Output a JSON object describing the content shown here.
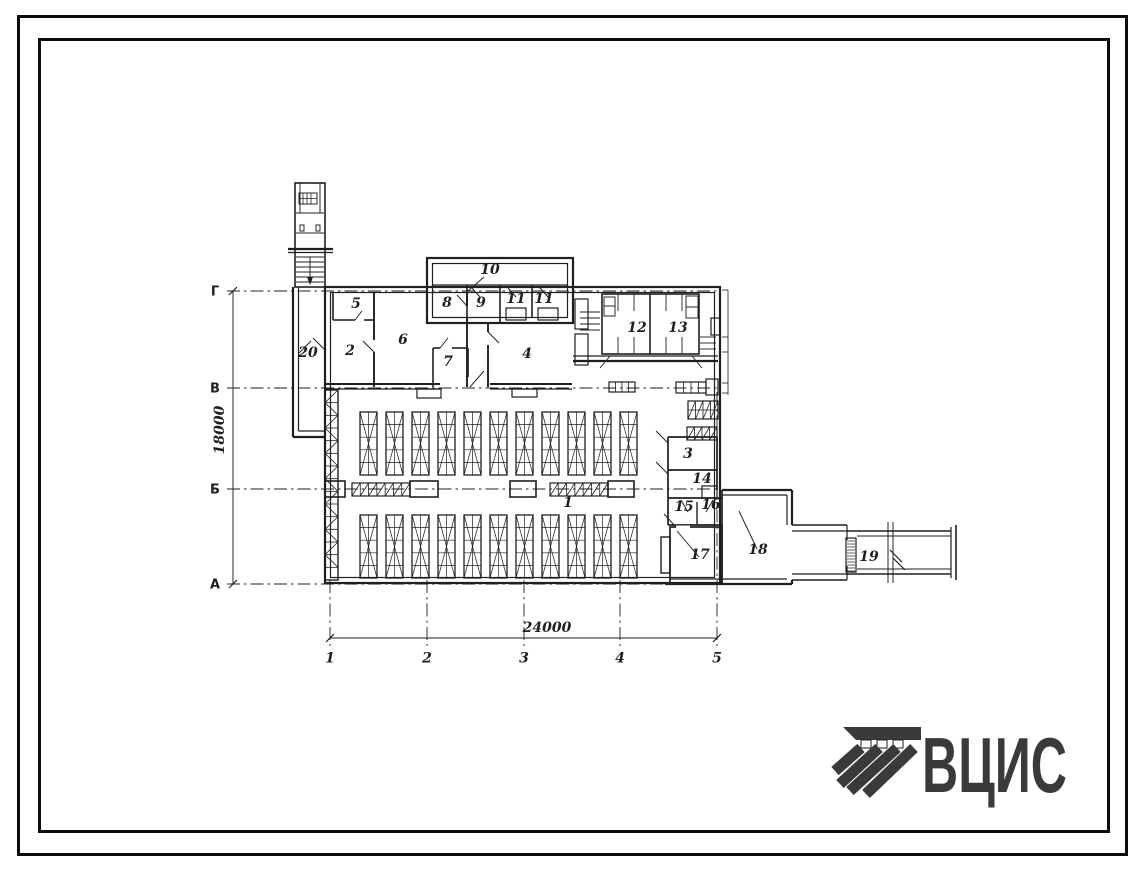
{
  "sheet": {
    "paper_color": "#ffffff",
    "ink_color": "#1f1f1f",
    "description": "architectural floor plan drawing"
  },
  "drawing": {
    "type": "floor_plan",
    "row_axes_x": 215,
    "row_axes": [
      {
        "label": "Г",
        "y": 291
      },
      {
        "label": "В",
        "y": 388
      },
      {
        "label": "Б",
        "y": 489
      },
      {
        "label": "А",
        "y": 584
      }
    ],
    "col_axes_y": 658,
    "col_axes": [
      {
        "label": "1",
        "x": 330
      },
      {
        "label": "2",
        "x": 427
      },
      {
        "label": "3",
        "x": 524
      },
      {
        "label": "4",
        "x": 620
      },
      {
        "label": "5",
        "x": 717
      }
    ],
    "dim_horizontal": {
      "text": "24000",
      "x": 547,
      "y": 632
    },
    "dim_vertical": {
      "text": "18000",
      "x": 224,
      "y": 430
    },
    "room_labels": [
      {
        "label": "1",
        "x": 568,
        "y": 507
      },
      {
        "label": "2",
        "x": 350,
        "y": 355
      },
      {
        "label": "3",
        "x": 688,
        "y": 458
      },
      {
        "label": "4",
        "x": 527,
        "y": 358
      },
      {
        "label": "5",
        "x": 356,
        "y": 308
      },
      {
        "label": "6",
        "x": 403,
        "y": 344
      },
      {
        "label": "7",
        "x": 448,
        "y": 366
      },
      {
        "label": "8",
        "x": 447,
        "y": 307
      },
      {
        "label": "9",
        "x": 481,
        "y": 307
      },
      {
        "label": "10",
        "x": 490,
        "y": 274
      },
      {
        "label": "11",
        "x": 516,
        "y": 303
      },
      {
        "label": "11",
        "x": 544,
        "y": 303
      },
      {
        "label": "12",
        "x": 637,
        "y": 332
      },
      {
        "label": "13",
        "x": 678,
        "y": 332
      },
      {
        "label": "14",
        "x": 702,
        "y": 483
      },
      {
        "label": "15",
        "x": 684,
        "y": 511
      },
      {
        "label": "16",
        "x": 711,
        "y": 509
      },
      {
        "label": "17",
        "x": 700,
        "y": 559
      },
      {
        "label": "18",
        "x": 758,
        "y": 554
      },
      {
        "label": "19",
        "x": 869,
        "y": 561
      },
      {
        "label": "20",
        "x": 308,
        "y": 357
      }
    ],
    "stalls": {
      "rows_y": [
        412,
        515
      ],
      "height": 63,
      "start_x": 360,
      "pitch": 26,
      "count": 11,
      "width": 17
    }
  },
  "logo": {
    "text": "ВЦИС",
    "color": "#3a3a3c"
  }
}
